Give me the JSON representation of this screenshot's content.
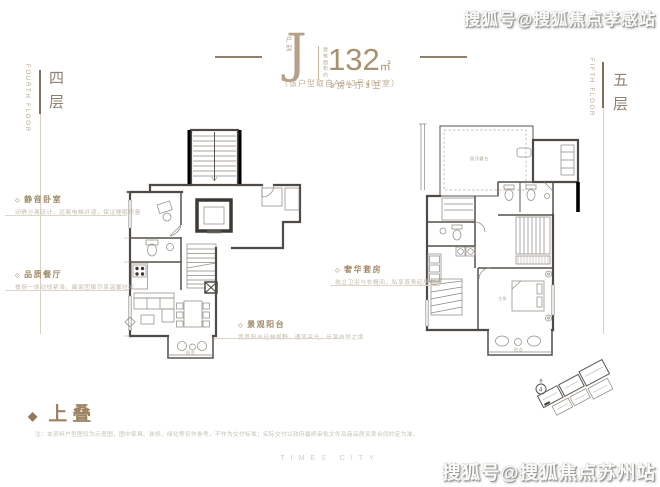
{
  "watermarks": {
    "top_right": "搜狐号@搜狐焦点孝感站",
    "bottom_right": "搜狐号@搜狐焦点苏州站"
  },
  "header": {
    "unit_type_label": "户型",
    "unit_letter": "J",
    "area_label": "建筑面积约",
    "area_value": "132",
    "area_unit": "㎡",
    "layout_text": "3房2厅3卫",
    "source_note": "（该户型取自A3#3号402室）"
  },
  "floor_labels": {
    "fourth": {
      "zh": "四层",
      "en": "FOURTH FLOOR"
    },
    "fifth": {
      "zh": "五层",
      "en": "FIFTH FLOOR"
    }
  },
  "annotations": {
    "quiet_bedroom": {
      "title": "静音卧室",
      "desc": "动静分离设计，远离电梯井道，保证睡眠质量"
    },
    "dining": {
      "title": "品质餐厅",
      "desc": "餐厨一体动线紧凑，阖家团聚尽享温馨时光"
    },
    "balcony": {
      "title": "景观阳台",
      "desc": "宽景阳台延伸视野，通风采光，乐享自然之境"
    },
    "master_suite": {
      "title": "奢华套房",
      "desc": "独立卫浴与衣帽间，私享尊贵起居体验"
    }
  },
  "plan_labels": {
    "fourth_balcony": "阳台",
    "fifth_terrace": "屋顶露台",
    "fifth_master": "主卧",
    "fifth_balcony": "阳台"
  },
  "icons": {
    "diamond_filled": "◆",
    "diamond_open": "◇"
  },
  "site_plan": {
    "marker": "4"
  },
  "footer": {
    "section_title": "上叠",
    "disclaimer": "注：本资料户型图仅为示意图，图中家具、装修、绿化等仅作参考，不作为交付标准；实际交付以政府最终审批文件及商品房买卖合同约定为准。",
    "brand": "TIMES CITY"
  }
}
